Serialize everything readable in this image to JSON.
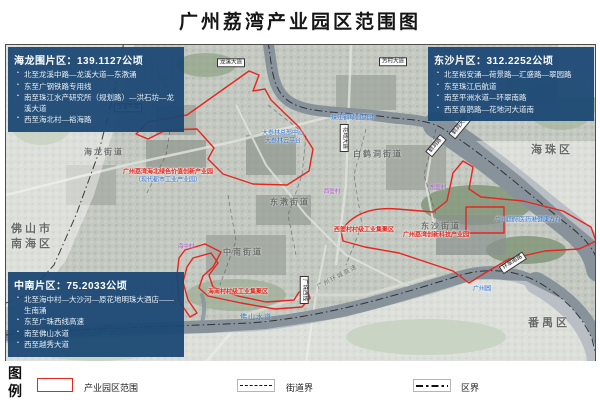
{
  "title": "广州荔湾产业园区范围图",
  "info_boxes": [
    {
      "title": "海龙围片区：139.1127公顷",
      "bullets": [
        "北至龙溪中路—龙溪大道—东漖涌",
        "东至广钢铁路专用线",
        "南至珠江水产研究所（规划路）—洪石坊—龙溪大道",
        "西至海北村—裕海路"
      ]
    },
    {
      "title": "东沙片区：312.2252公顷",
      "bullets": [
        "北至裕安涌—荷景路—汇盛路—翠园路",
        "东至珠江后航道",
        "南至平洲水道—环翠南路",
        "西至喜鹊路—花地河大道南"
      ]
    },
    {
      "title": "中南片区：75.2033公顷",
      "bullets": [
        "北至海中村—大沙河—原花地明珠大酒店——生南涌",
        "东至广珠西线高速",
        "南至佛山水道",
        "西至越秀大道"
      ]
    }
  ],
  "legend": {
    "heading": "图例",
    "items": [
      {
        "type": "park-outline",
        "label": "产业园区范围"
      },
      {
        "type": "street-boundary",
        "label": "街道界"
      },
      {
        "type": "district-boundary",
        "label": "区界"
      }
    ]
  },
  "map": {
    "labels": [
      {
        "text": "海珠区",
        "type": "district",
        "x": 552,
        "y": 149
      },
      {
        "text": "番禺区",
        "type": "district",
        "x": 549,
        "y": 322
      },
      {
        "text": "佛山市",
        "type": "district",
        "x": 32,
        "y": 228
      },
      {
        "text": "南海区",
        "type": "district",
        "x": 32,
        "y": 243
      },
      {
        "text": "海龙街道",
        "type": "subdistrict",
        "x": 104,
        "y": 152
      },
      {
        "text": "东漖街道",
        "type": "subdistrict",
        "x": 290,
        "y": 202
      },
      {
        "text": "白鹤洞街道",
        "type": "subdistrict",
        "x": 378,
        "y": 154
      },
      {
        "text": "东沙街道",
        "type": "subdistrict",
        "x": 441,
        "y": 226
      },
      {
        "text": "中南街道",
        "type": "subdistrict",
        "x": 243,
        "y": 252
      },
      {
        "text": "广州荔湾海北绿色价值创新产业园",
        "type": "red",
        "x": 168,
        "y": 171
      },
      {
        "text": "（现代都市工业产业园）",
        "type": "blue",
        "x": 168,
        "y": 179
      },
      {
        "text": "西塱村村级工业集聚区",
        "type": "red",
        "x": 364,
        "y": 229
      },
      {
        "text": "广州荔湾创新科技产业园",
        "type": "red",
        "x": 436,
        "y": 234
      },
      {
        "text": "海南村村级工业集聚区",
        "type": "red",
        "x": 238,
        "y": 291
      },
      {
        "text": "大参林总部中心",
        "type": "blue",
        "x": 283,
        "y": 132
      },
      {
        "text": "大参林云平台",
        "type": "blue",
        "x": 283,
        "y": 140
      },
      {
        "text": "珠江钢琴创梦园",
        "type": "blue",
        "x": 352,
        "y": 117
      },
      {
        "text": "广州国际医药港健康方舟",
        "type": "blue",
        "x": 528,
        "y": 219
      },
      {
        "text": "广州圆",
        "type": "blue",
        "x": 482,
        "y": 288
      },
      {
        "text": "佛山水道",
        "type": "water",
        "x": 256,
        "y": 317
      },
      {
        "text": "海中村",
        "type": "village",
        "x": 186,
        "y": 246
      },
      {
        "text": "东塱村",
        "type": "village",
        "x": 438,
        "y": 187
      },
      {
        "text": "西塱村",
        "type": "village",
        "x": 332,
        "y": 191
      },
      {
        "text": "龙溪大道",
        "type": "roadbox",
        "x": 231,
        "y": 63,
        "rot": 0
      },
      {
        "text": "芳村大道",
        "type": "roadbox",
        "x": 393,
        "y": 62,
        "rot": 0
      },
      {
        "text": "龙溪中路",
        "type": "roadbox",
        "x": 128,
        "y": 108,
        "rot": 0
      },
      {
        "text": "花地大道",
        "type": "roadbox",
        "x": 344,
        "y": 138,
        "rot": 90
      },
      {
        "text": "鹤洞大桥",
        "type": "roadbox",
        "x": 461,
        "y": 126,
        "rot": -50
      },
      {
        "text": "鹤洞路",
        "type": "roadbox",
        "x": 436,
        "y": 146,
        "rot": -50
      },
      {
        "text": "广珠西线",
        "type": "roadbox",
        "x": 304,
        "y": 290,
        "rot": 90
      },
      {
        "text": "环翠南路",
        "type": "roadbox",
        "x": 513,
        "y": 263,
        "rot": -33
      },
      {
        "text": "广州环城高速",
        "type": "roadtext",
        "x": 337,
        "y": 276,
        "rot": -28
      }
    ]
  },
  "colors": {
    "park_outline": "#e8251f",
    "info_box_bg": "#1b4773",
    "water": "#87929a",
    "district_text": "#4e5450"
  }
}
